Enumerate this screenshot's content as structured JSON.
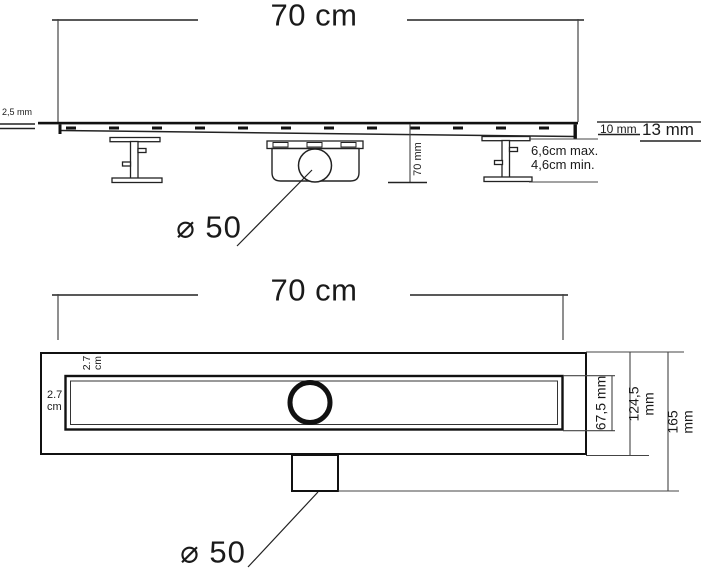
{
  "side_view": {
    "length_label": "70 cm",
    "grate_thickness_label": "2,5 mm",
    "depth_10_label": "10 mm",
    "depth_13_label": "13 mm",
    "height_label": "70 mm",
    "foot_max_label": "6,6cm max.",
    "foot_min_label": "4,6cm min.",
    "outlet_diameter_label": "⌀ 50"
  },
  "plan_view": {
    "length_label": "70 cm",
    "top_offset_label": "2.7\ncm",
    "left_offset_label": "2.7\ncm",
    "channel_width_label": "67,5 mm",
    "flange_width_label": "124,5 mm",
    "total_width_label": "165 mm",
    "outlet_diameter_label": "⌀ 50"
  },
  "colors": {
    "line": "#111111",
    "secondary_line": "#222222",
    "dimension_line": "#444444",
    "background": "#ffffff",
    "text": "#1a1a1a"
  }
}
